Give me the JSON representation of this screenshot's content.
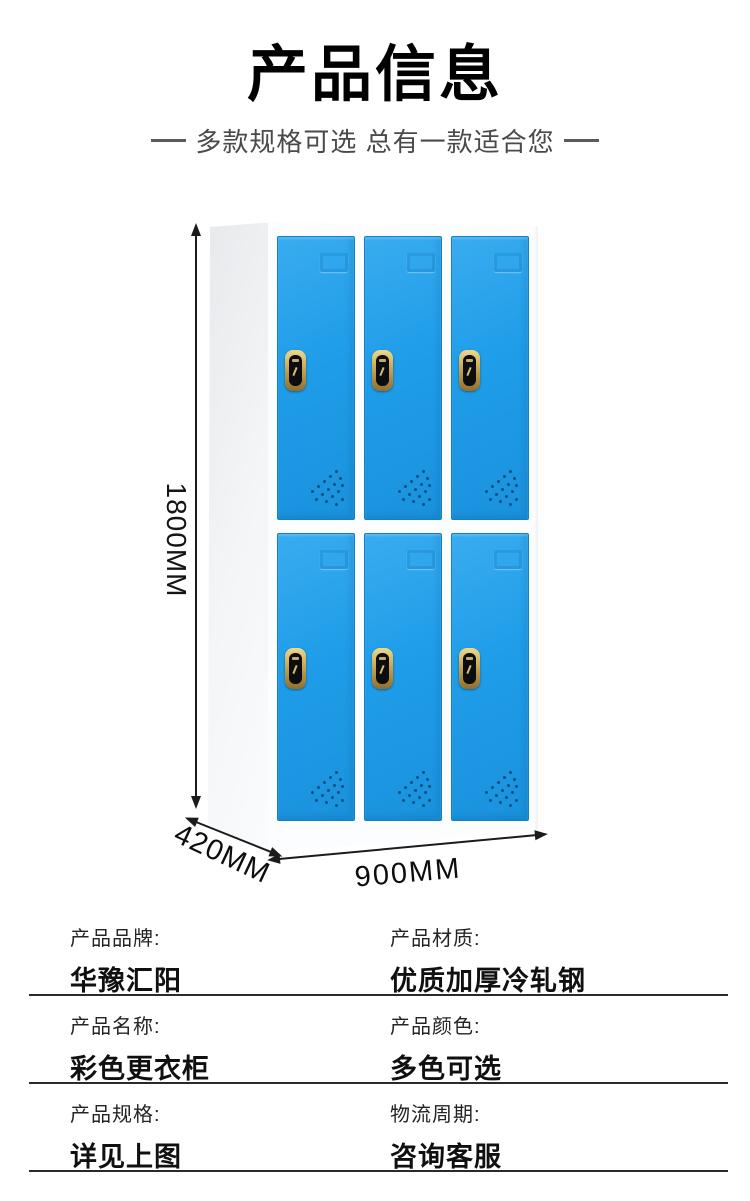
{
  "header": {
    "title": "产品信息",
    "subtitle": "多款规格可选 总有一款适合您"
  },
  "colors": {
    "door": "#1f9de8",
    "door-edge": "#0f81c6",
    "lock-gold": "#c8a551",
    "dimension-line": "#1b1b1b",
    "table-line": "#2a2a2a"
  },
  "figure": {
    "height_label": "1800MM",
    "depth_label": "420MM",
    "width_label": "900MM",
    "door_rows": 2,
    "door_columns": 3
  },
  "specs": {
    "rows": [
      {
        "left": {
          "label": "产品品牌:",
          "value": "华豫汇阳"
        },
        "right": {
          "label": "产品材质:",
          "value": "优质加厚冷轧钢"
        }
      },
      {
        "left": {
          "label": "产品名称:",
          "value": "彩色更衣柜"
        },
        "right": {
          "label": "产品颜色:",
          "value": "多色可选"
        }
      },
      {
        "left": {
          "label": "产品规格:",
          "value": "详见上图"
        },
        "right": {
          "label": "物流周期:",
          "value": "咨询客服"
        }
      }
    ]
  }
}
